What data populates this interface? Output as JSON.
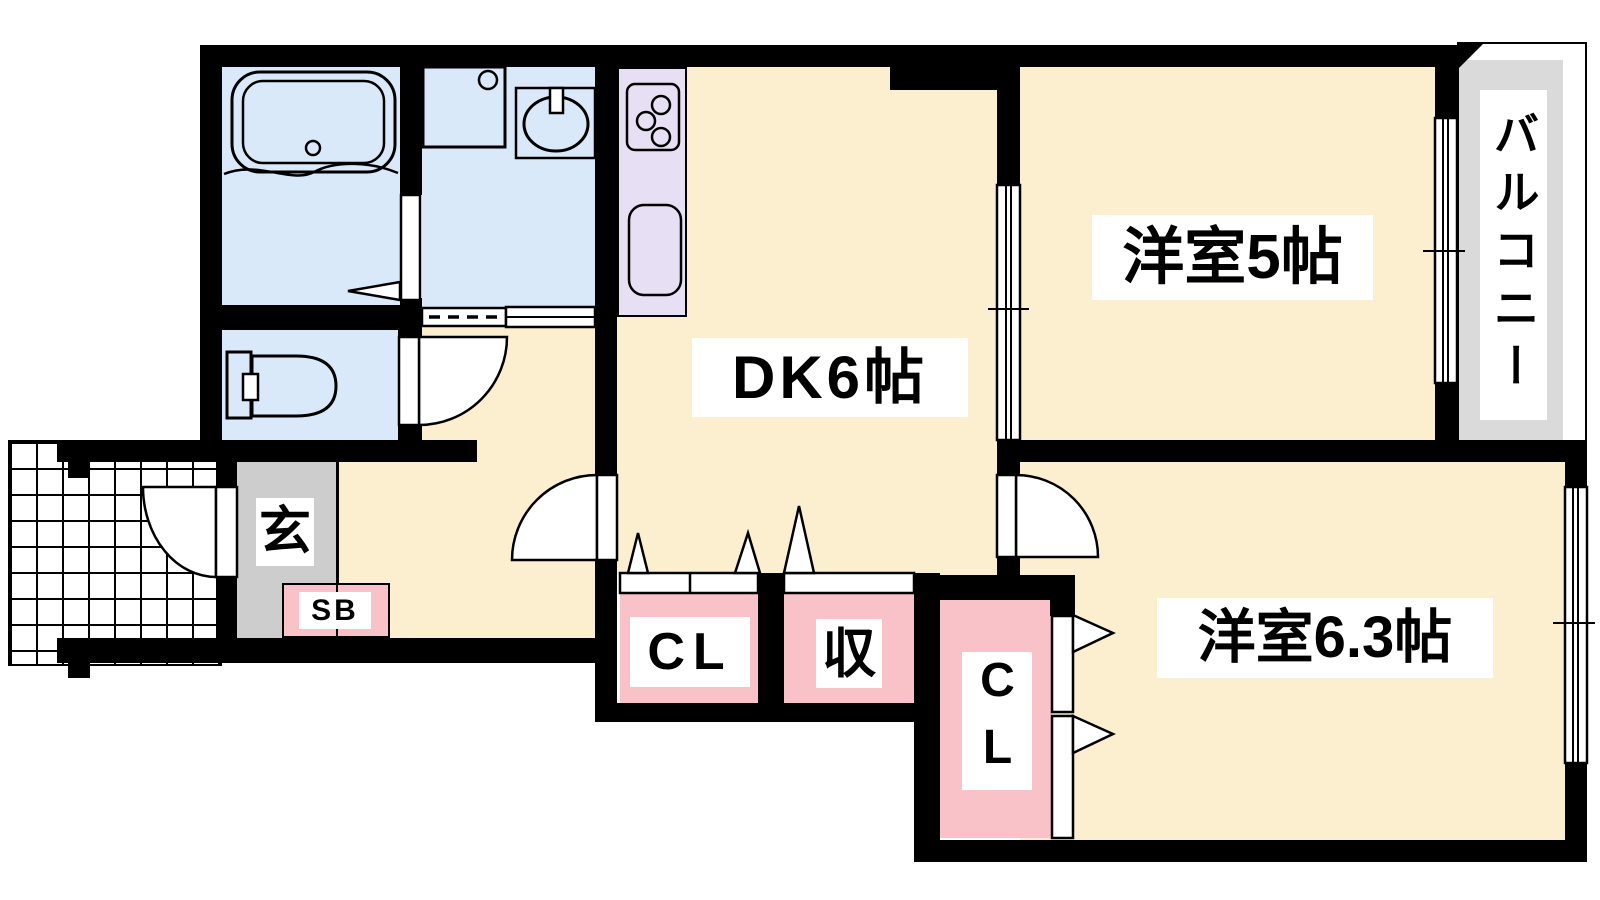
{
  "floor_plan": {
    "rooms": {
      "dining_kitchen": {
        "label": "DK6帖"
      },
      "western_room_5": {
        "label": "洋室5帖"
      },
      "western_room_6_3": {
        "label": "洋室6.3帖"
      },
      "balcony": {
        "label": "バルコニー"
      },
      "entrance": {
        "label": "玄"
      },
      "shoe_box": {
        "label": "SB"
      },
      "hall_closet": {
        "label": "CL"
      },
      "storage": {
        "label": "収"
      },
      "bedroom_closet": {
        "label": "CL"
      }
    },
    "colors": {
      "wall": "#000000",
      "room_floor": "#FBEFD0",
      "wet_area_floor": "#DAE9FA",
      "kitchen_counter": "#E7DFF3",
      "closet_floor": "#F9C2C8",
      "entrance_floor": "#CDCDCD",
      "balcony_floor": "#DADADA",
      "label_background": "#FFFFFF"
    }
  }
}
